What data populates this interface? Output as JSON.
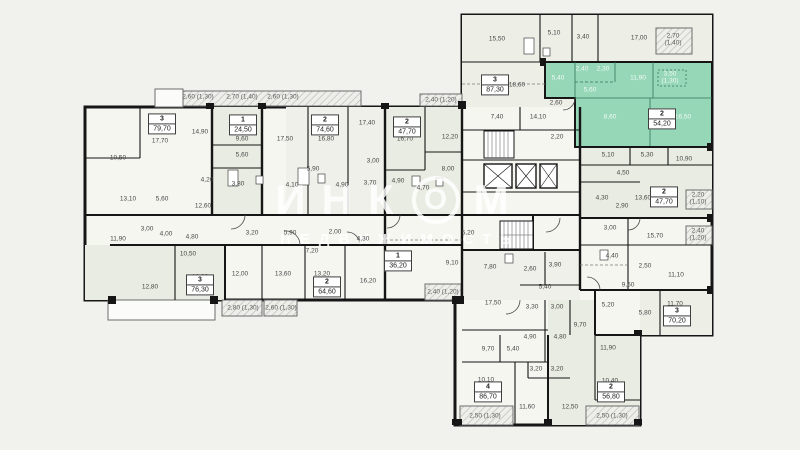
{
  "watermark": {
    "brand_left": "ИНК",
    "brand_o": "О",
    "brand_right": "М",
    "sub": "НЕДВИЖИМОСТЬ"
  },
  "colors": {
    "background": "#f1f1ed",
    "room_light": "#f6f6f1",
    "room_shaded": "#e9ece2",
    "highlight": "#96d7b8",
    "wall": "#161616",
    "label_text": "#474747"
  },
  "units": [
    {
      "type": "3",
      "area": "79,70",
      "x": 162,
      "y": 124
    },
    {
      "type": "1",
      "area": "24,50",
      "x": 243,
      "y": 125
    },
    {
      "type": "2",
      "area": "74,60",
      "x": 325,
      "y": 125
    },
    {
      "type": "2",
      "area": "47,70",
      "x": 407,
      "y": 127
    },
    {
      "type": "3",
      "area": "87,30",
      "x": 495,
      "y": 85
    },
    {
      "type": "2",
      "area": "54,20",
      "x": 662,
      "y": 119,
      "highlighted": true
    },
    {
      "type": "2",
      "area": "47,70",
      "x": 664,
      "y": 197
    },
    {
      "type": "3",
      "area": "76,30",
      "x": 200,
      "y": 285
    },
    {
      "type": "2",
      "area": "64,60",
      "x": 327,
      "y": 287
    },
    {
      "type": "1",
      "area": "36,20",
      "x": 398,
      "y": 261
    },
    {
      "type": "4",
      "area": "86,70",
      "x": 488,
      "y": 392
    },
    {
      "type": "2",
      "area": "56,80",
      "x": 611,
      "y": 392
    },
    {
      "type": "3",
      "area": "70,20",
      "x": 677,
      "y": 316
    }
  ],
  "rooms": [
    {
      "v": "10,50",
      "x": 118,
      "y": 158
    },
    {
      "v": "17,70",
      "x": 160,
      "y": 141
    },
    {
      "v": "14,90",
      "x": 200,
      "y": 132
    },
    {
      "v": "13,10",
      "x": 128,
      "y": 199
    },
    {
      "v": "5,60",
      "x": 162,
      "y": 199
    },
    {
      "v": "9,60",
      "x": 242,
      "y": 139
    },
    {
      "v": "5,60",
      "x": 242,
      "y": 155
    },
    {
      "v": "3,80",
      "x": 238,
      "y": 184
    },
    {
      "v": "4,20",
      "x": 207,
      "y": 180
    },
    {
      "v": "4,10",
      "x": 292,
      "y": 185
    },
    {
      "v": "17,50",
      "x": 285,
      "y": 139
    },
    {
      "v": "16,80",
      "x": 326,
      "y": 139
    },
    {
      "v": "17,40",
      "x": 367,
      "y": 123
    },
    {
      "v": "5,90",
      "x": 313,
      "y": 169
    },
    {
      "v": "3,00",
      "x": 373,
      "y": 161
    },
    {
      "v": "4,90",
      "x": 342,
      "y": 185
    },
    {
      "v": "3,70",
      "x": 370,
      "y": 183
    },
    {
      "v": "16,70",
      "x": 405,
      "y": 139
    },
    {
      "v": "12,20",
      "x": 450,
      "y": 137
    },
    {
      "v": "4,90",
      "x": 398,
      "y": 181
    },
    {
      "v": "4,70",
      "x": 423,
      "y": 188
    },
    {
      "v": "8,00",
      "x": 448,
      "y": 169
    },
    {
      "v": "12,60",
      "x": 203,
      "y": 206
    },
    {
      "v": "11,90",
      "x": 118,
      "y": 239
    },
    {
      "v": "3,00",
      "x": 147,
      "y": 229
    },
    {
      "v": "4,00",
      "x": 166,
      "y": 234
    },
    {
      "v": "4,80",
      "x": 192,
      "y": 237
    },
    {
      "v": "10,50",
      "x": 188,
      "y": 254
    },
    {
      "v": "3,20",
      "x": 252,
      "y": 233
    },
    {
      "v": "5,90",
      "x": 290,
      "y": 233
    },
    {
      "v": "2,00",
      "x": 335,
      "y": 232
    },
    {
      "v": "4,30",
      "x": 363,
      "y": 239
    },
    {
      "v": "7,20",
      "x": 312,
      "y": 251
    },
    {
      "v": "12,80",
      "x": 150,
      "y": 287
    },
    {
      "v": "12,80",
      "x": 200,
      "y": 277
    },
    {
      "v": "12,00",
      "x": 240,
      "y": 274
    },
    {
      "v": "13,60",
      "x": 283,
      "y": 274
    },
    {
      "v": "13,20",
      "x": 322,
      "y": 274
    },
    {
      "v": "16,20",
      "x": 368,
      "y": 281
    },
    {
      "v": "9,10",
      "x": 452,
      "y": 263
    },
    {
      "v": "15,50",
      "x": 497,
      "y": 39
    },
    {
      "v": "5,10",
      "x": 554,
      "y": 33
    },
    {
      "v": "3,40",
      "x": 583,
      "y": 37
    },
    {
      "v": "17,00",
      "x": 639,
      "y": 38
    },
    {
      "v": "18,60",
      "x": 517,
      "y": 85
    },
    {
      "v": "7,40",
      "x": 497,
      "y": 117
    },
    {
      "v": "14,10",
      "x": 538,
      "y": 117
    },
    {
      "v": "2,60",
      "x": 556,
      "y": 103
    },
    {
      "v": "2,20",
      "x": 557,
      "y": 137
    },
    {
      "v": "5,40",
      "x": 558,
      "y": 78,
      "g": true
    },
    {
      "v": "2,40",
      "x": 582,
      "y": 69,
      "g": true
    },
    {
      "v": "2,30",
      "x": 603,
      "y": 69,
      "g": true
    },
    {
      "v": "11,90",
      "x": 638,
      "y": 78,
      "g": true
    },
    {
      "v": "5,60",
      "x": 590,
      "y": 90,
      "g": true
    },
    {
      "v": "8,60",
      "x": 610,
      "y": 117,
      "g": true
    },
    {
      "v": "16,50",
      "x": 683,
      "y": 117,
      "g": true
    },
    {
      "v": "5,10",
      "x": 608,
      "y": 155
    },
    {
      "v": "5,30",
      "x": 647,
      "y": 155
    },
    {
      "v": "10,90",
      "x": 684,
      "y": 159
    },
    {
      "v": "4,50",
      "x": 623,
      "y": 173
    },
    {
      "v": "4,30",
      "x": 602,
      "y": 198
    },
    {
      "v": "2,90",
      "x": 622,
      "y": 206
    },
    {
      "v": "13,60",
      "x": 643,
      "y": 198
    },
    {
      "v": "3,00",
      "x": 610,
      "y": 228
    },
    {
      "v": "15,70",
      "x": 655,
      "y": 236
    },
    {
      "v": "4,40",
      "x": 612,
      "y": 256
    },
    {
      "v": "2,50",
      "x": 645,
      "y": 266
    },
    {
      "v": "11,10",
      "x": 676,
      "y": 275
    },
    {
      "v": "9,60",
      "x": 628,
      "y": 285
    },
    {
      "v": "5,20",
      "x": 608,
      "y": 305
    },
    {
      "v": "5,80",
      "x": 645,
      "y": 313
    },
    {
      "v": "11,70",
      "x": 675,
      "y": 304
    },
    {
      "v": "11,90",
      "x": 608,
      "y": 348
    },
    {
      "v": "10,40",
      "x": 610,
      "y": 381
    },
    {
      "v": "5,20",
      "x": 468,
      "y": 233
    },
    {
      "v": "7,80",
      "x": 490,
      "y": 267
    },
    {
      "v": "2,60",
      "x": 530,
      "y": 269
    },
    {
      "v": "3,90",
      "x": 555,
      "y": 265
    },
    {
      "v": "5,40",
      "x": 545,
      "y": 287
    },
    {
      "v": "17,50",
      "x": 493,
      "y": 303
    },
    {
      "v": "3,30",
      "x": 532,
      "y": 307
    },
    {
      "v": "3,00",
      "x": 557,
      "y": 307
    },
    {
      "v": "9,70",
      "x": 580,
      "y": 325
    },
    {
      "v": "4,90",
      "x": 530,
      "y": 337
    },
    {
      "v": "4,80",
      "x": 560,
      "y": 337
    },
    {
      "v": "9,70",
      "x": 488,
      "y": 349
    },
    {
      "v": "5,40",
      "x": 513,
      "y": 349
    },
    {
      "v": "3,20",
      "x": 536,
      "y": 369
    },
    {
      "v": "3,20",
      "x": 557,
      "y": 369
    },
    {
      "v": "10,10",
      "x": 486,
      "y": 380
    },
    {
      "v": "11,60",
      "x": 527,
      "y": 407
    },
    {
      "v": "12,50",
      "x": 570,
      "y": 407
    }
  ],
  "balconies": [
    {
      "v": "2,60 (1,30)",
      "x": 198,
      "y": 97
    },
    {
      "v": "2,70 (1,40)",
      "x": 242,
      "y": 97
    },
    {
      "v": "2,60 (1,30)",
      "x": 283,
      "y": 97
    },
    {
      "v": "2,40 (1,20)",
      "x": 441,
      "y": 100
    },
    {
      "v": "2,70",
      "l2": "(1,40)",
      "x": 673,
      "y": 40
    },
    {
      "v": "3,50",
      "l2": "(1,30)",
      "x": 670,
      "y": 78,
      "g": true
    },
    {
      "v": "2,20",
      "l2": "(1,10)",
      "x": 698,
      "y": 199
    },
    {
      "v": "2,40",
      "l2": "(1,20)",
      "x": 698,
      "y": 235
    },
    {
      "v": "2,40 (1,20)",
      "x": 443,
      "y": 292
    },
    {
      "v": "2,80 (1,30)",
      "x": 243,
      "y": 308
    },
    {
      "v": "2,60 (1,30)",
      "x": 281,
      "y": 308
    },
    {
      "v": "2,50 (1,30)",
      "x": 485,
      "y": 416
    },
    {
      "v": "2,50 (1,30)",
      "x": 612,
      "y": 416
    }
  ]
}
